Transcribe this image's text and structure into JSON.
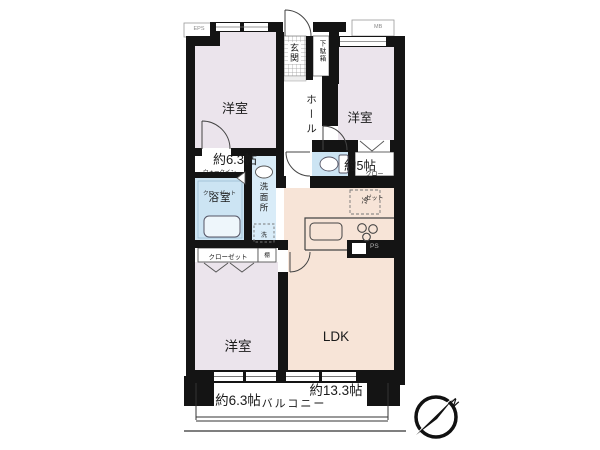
{
  "floorplan": {
    "bedroom1": {
      "label": "洋室",
      "size": "約6.3帖"
    },
    "bedroom2": {
      "label": "洋室",
      "size": "約5帖"
    },
    "bedroom3": {
      "label": "洋室",
      "size": "約6.3帖"
    },
    "ldk": {
      "label": "LDK",
      "size": "約13.3帖"
    },
    "entrance": {
      "label": "玄関"
    },
    "shoe_cabinet": {
      "label": "下駄箱"
    },
    "hall": {
      "label": "ホール"
    },
    "walk_in_closet": {
      "line1": "ウォークイン",
      "line2": "クローゼット"
    },
    "bathroom": {
      "label": "浴室"
    },
    "washroom": {
      "label": "洗面所"
    },
    "washer": {
      "label": "洗"
    },
    "closet_bedroom2": {
      "line1": "クロー",
      "line2": "ゼット"
    },
    "closet_bedroom3": {
      "label": "クローゼット"
    },
    "shelf": {
      "label": "棚"
    },
    "refrigerator": {
      "label": "冷"
    },
    "balcony": {
      "label": "バルコニー"
    },
    "eps": {
      "label": "EPS"
    },
    "meter_box": {
      "label": "MB"
    },
    "pipe_space": {
      "label": "PS"
    },
    "compass": {
      "north": "N"
    },
    "colors": {
      "bedroom_fill": "#ebe4ec",
      "ldk_fill": "#f7e4d7",
      "water_fill": "#cce4f3",
      "washroom_fill": "#d9ecf8",
      "wall": "#141414"
    }
  }
}
